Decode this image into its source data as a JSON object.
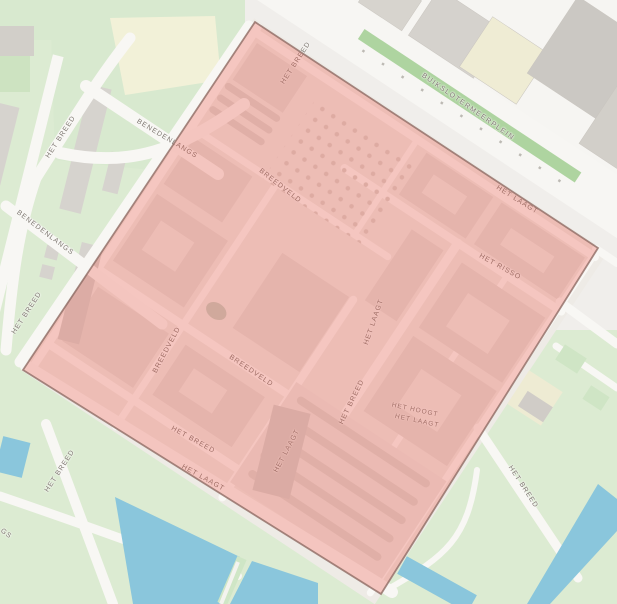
{
  "map": {
    "type": "street-map-with-selection-overlay",
    "labels": [
      {
        "text": "HET BREED"
      },
      {
        "text": "BENEDENLANGS"
      },
      {
        "text": "BENEDENLANGS"
      },
      {
        "text": "HET BREED"
      },
      {
        "text": "BREEDVELD"
      },
      {
        "text": "BUIKSLOTERMEERPLEIN"
      },
      {
        "text": "HET LAAGT"
      },
      {
        "text": "HET RISSO"
      },
      {
        "text": "BREEDVELD"
      },
      {
        "text": "BREEDVELD"
      },
      {
        "text": "HET BREED"
      },
      {
        "text": "HET LAAGT"
      },
      {
        "text": "HET LAAGT"
      },
      {
        "text": "HET LAAGT"
      },
      {
        "text": "HET BREED"
      },
      {
        "text": "HET HOOGT"
      },
      {
        "text": "HET LAAGT"
      },
      {
        "text": "HET BREED"
      },
      {
        "text": "HET BREED"
      },
      {
        "text": "HET BREED"
      },
      {
        "text": "GS"
      }
    ],
    "overlay": {
      "shape": "rotated-rectangle",
      "corners_px": [
        [
          255,
          22
        ],
        [
          598,
          248
        ],
        [
          381,
          594
        ],
        [
          23,
          370
        ]
      ],
      "fill_color": "#EA5444",
      "fill_opacity": 0.3,
      "border_color": "#8E6B64"
    },
    "colors": {
      "background": "#F0EEEB",
      "road": "#F8F7F4",
      "park_green": "#DCEBD2",
      "bright_green_strip": "#AED4A0",
      "water": "#8AC6DC",
      "building_gray": "#D5D2CD",
      "building_dark_gray": "#CBC8C3",
      "building_yellow": "#EFECD4",
      "building_neighborhood": "#E2DED8",
      "label_text": "#7E7871"
    }
  }
}
